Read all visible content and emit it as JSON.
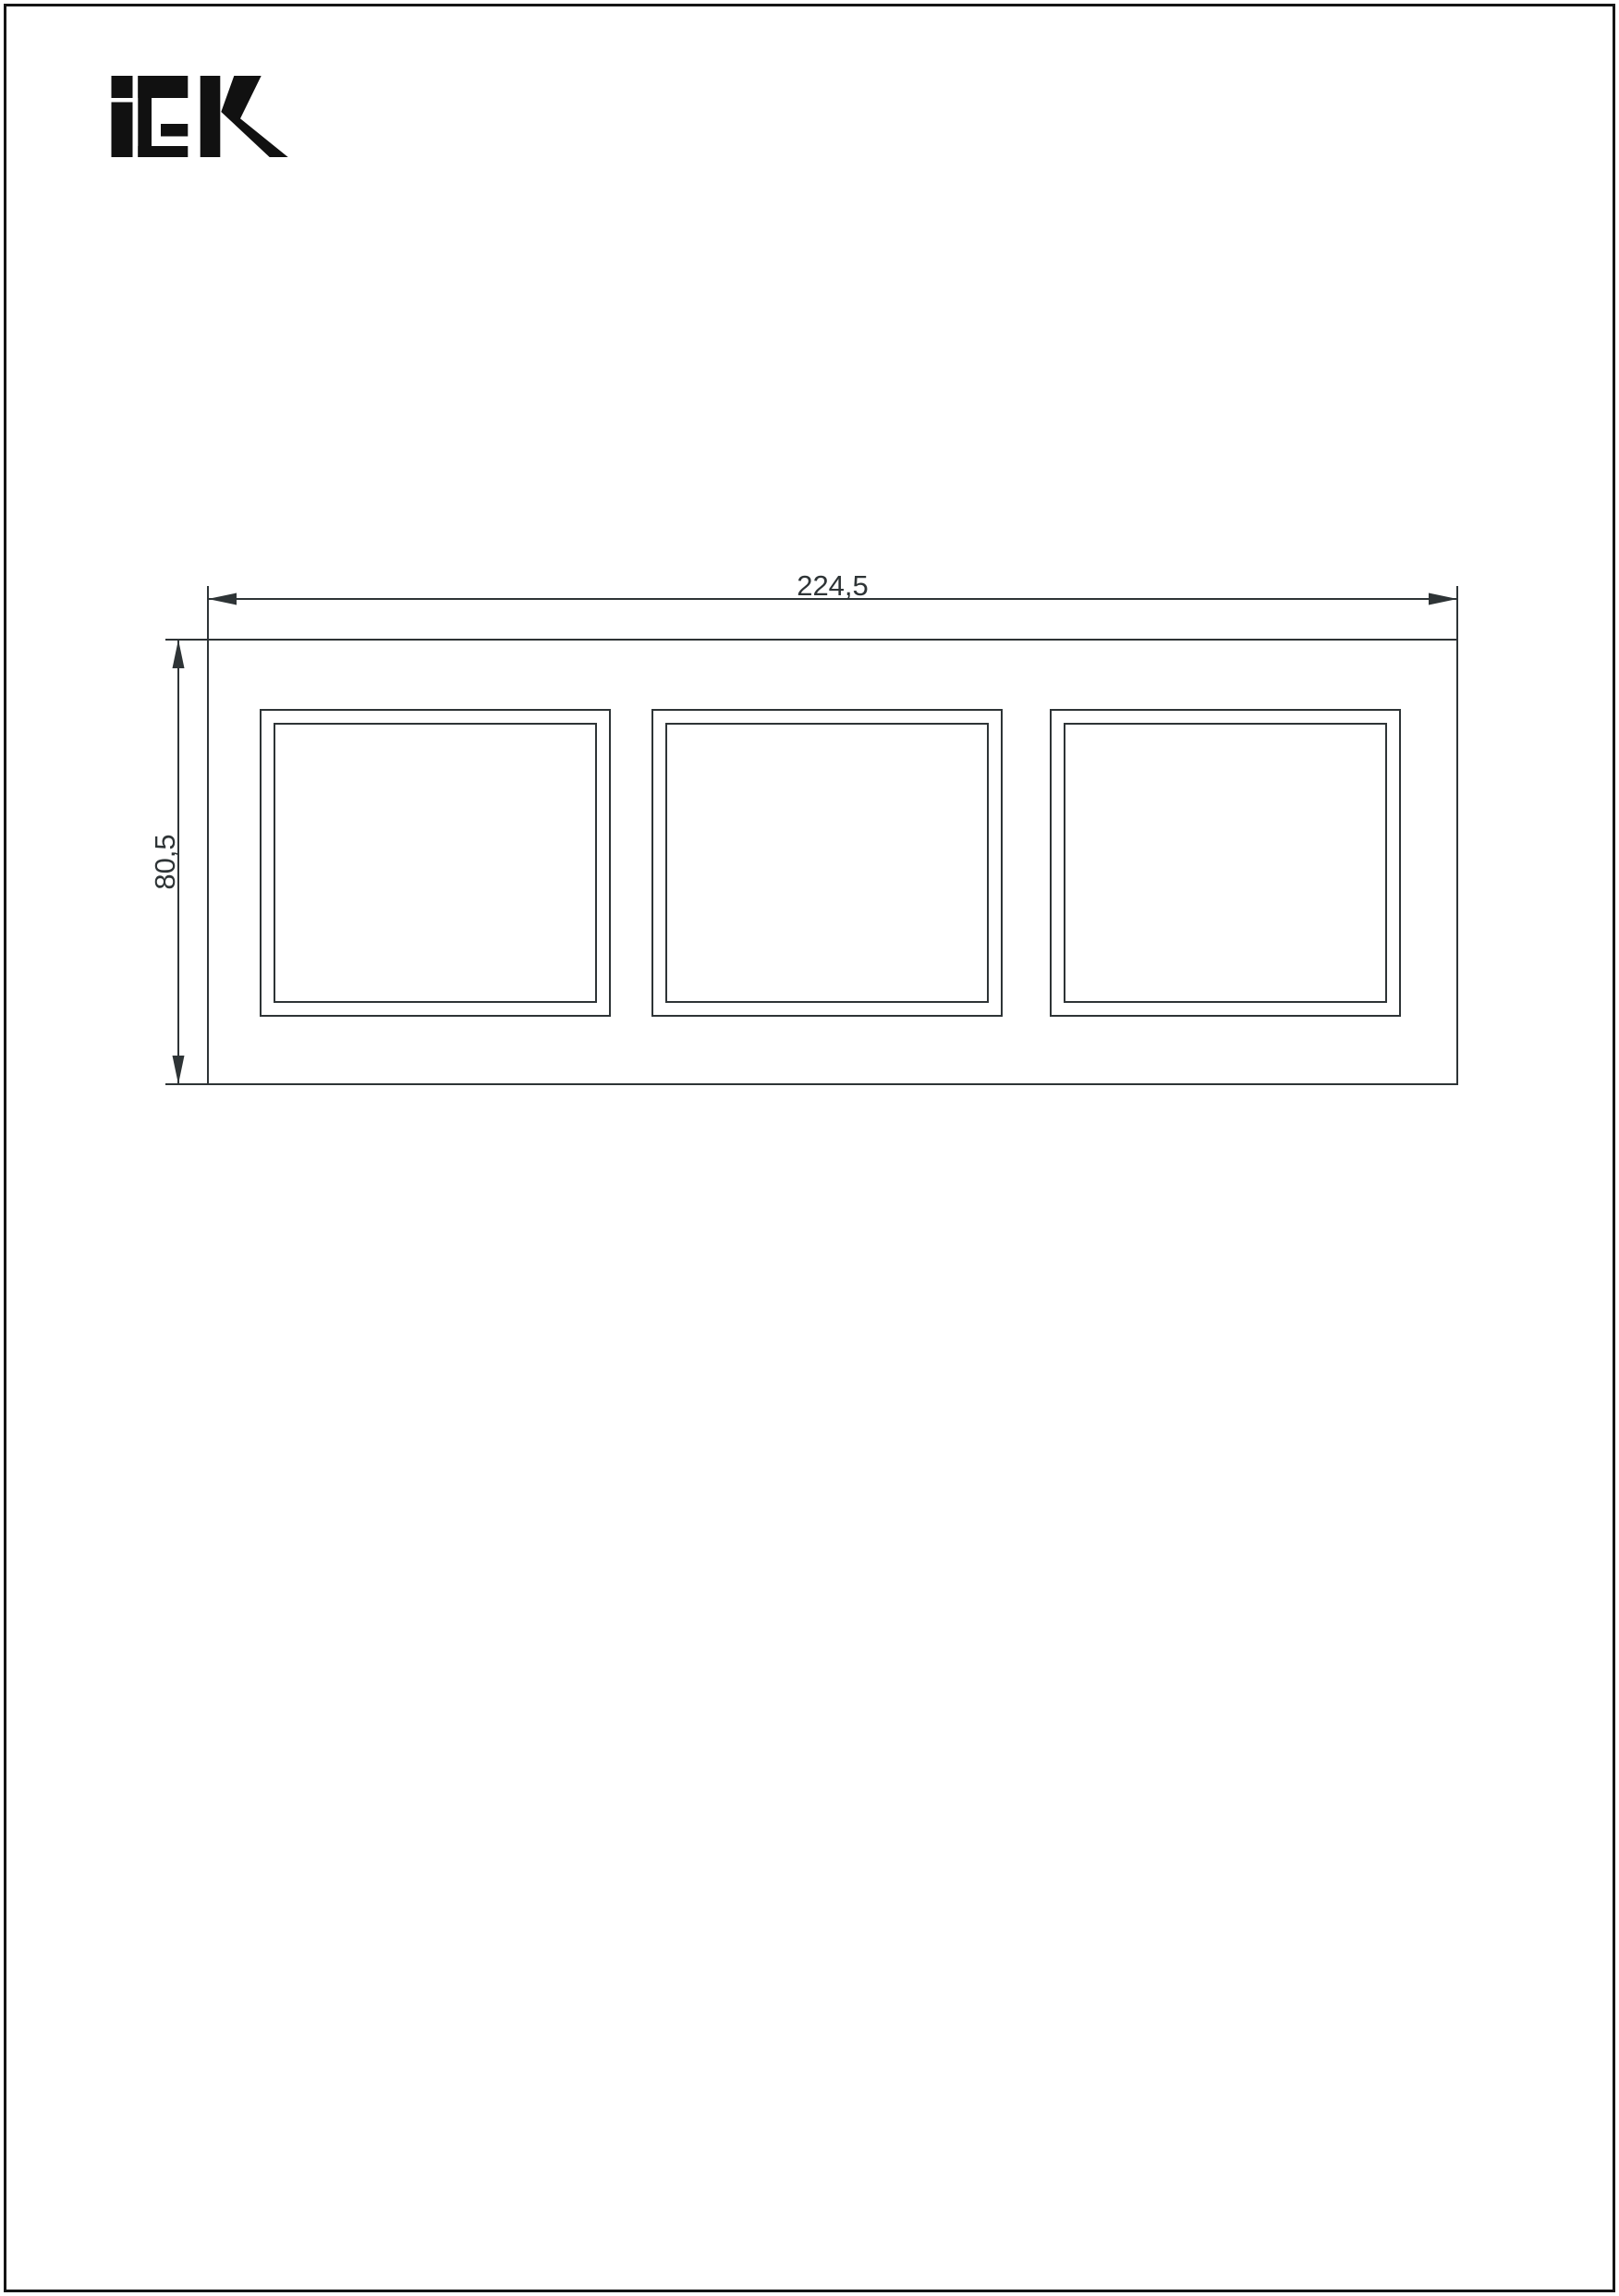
{
  "page": {
    "background": "#ffffff",
    "border_color": "#151515"
  },
  "logo": {
    "brand": "IEK",
    "color": "#111111"
  },
  "drawing": {
    "line_color": "#2e3436",
    "windows_count": 3,
    "width_dim": {
      "label": "224,5",
      "value_mm": 224.5
    },
    "height_dim": {
      "label": "80,5",
      "value_mm": 80.5
    }
  }
}
